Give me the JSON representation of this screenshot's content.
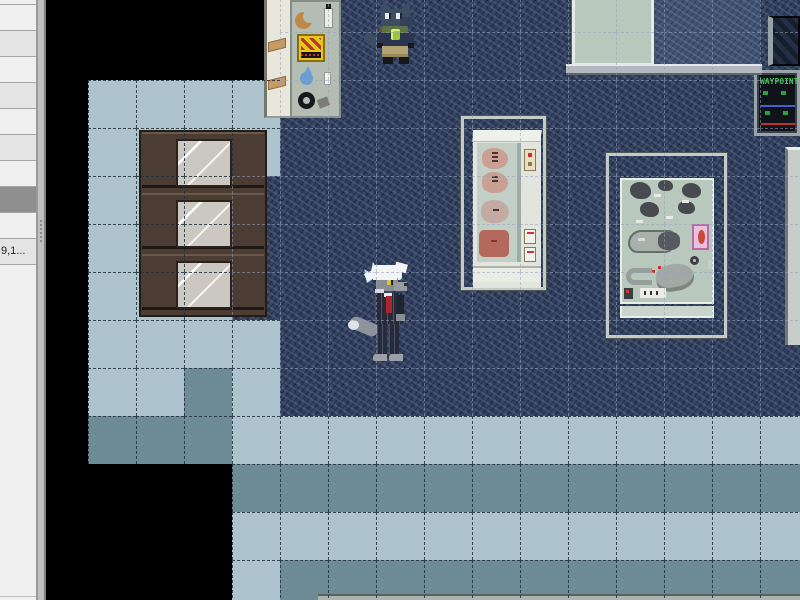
{
  "window": {
    "width": 800,
    "height": 600,
    "kind": "map-editor-viewport"
  },
  "sidebar": {
    "rows": [
      {
        "label": ""
      },
      {
        "label": ""
      },
      {
        "label": ""
      },
      {
        "label": ""
      },
      {
        "label": ""
      },
      {
        "label": ""
      },
      {
        "label": ""
      },
      {
        "label": "",
        "selected": true
      },
      {
        "label": ""
      },
      {
        "label": "9,1..."
      },
      {
        "label": ""
      }
    ],
    "colors": {
      "row_even": "#f0f0f0",
      "row_odd": "#e4e4e4",
      "selected": "#8f8f8f",
      "separator": "#a5a5a5",
      "background": "#f0f0f0",
      "splitter": "#bfbfbf"
    }
  },
  "map": {
    "tile_size": 48,
    "origin_x": -6,
    "origin_y": -16,
    "legend": {
      "K": "void-black",
      "L": "floor-light",
      "T": "floor-teal",
      "C": "carpet-dark-navy",
      "D": "carpet-light-navy"
    },
    "palette": {
      "K": "#000000",
      "L": "#adc3ce",
      "T": "#6d8c96",
      "C": "#2f3d59",
      "D": "#415372"
    },
    "grid_line_on_light": "rgba(35,48,58,0.85)",
    "grid_line_on_dark": "rgba(150,162,184,0.55)",
    "tiles": [
      "KKKKKCCCCCCCCCCC",
      "KKKKKCCCCCCCCCCC",
      "KLLLLCCCCCCCCCCC",
      "KLLLLCCCCCCCCCCC",
      "KLLLCCCCCCCCCCCC",
      "KLLLCCCCCCCCCCCC",
      "KLLLCCCCCCCCCCCC",
      "KLLLLCCCCCCCCCCC",
      "KLLTLCCCCCCCCCCC",
      "KTTTLLLLLLLLLLLL",
      "KKKKTTTTTTTTTTTT",
      "KKKKLLLLLLLLLLLL",
      "KKKKLTTTTTTTTTTT"
    ]
  },
  "entities": {
    "waypoint_sign": {
      "label": "WAYPOINT",
      "text_color": "#3ec94a",
      "accent_blue": "#4a5ad8",
      "accent_red": "#c03030"
    },
    "npc": {
      "description": "dark blue wolf with green scarf and glowing gem"
    },
    "player": {
      "description": "gray wolf with white hair in pinstripe suit and red tie"
    },
    "shelf_items": [
      "croissant",
      "bottle",
      "chips-bag",
      "water-drop",
      "pill",
      "pretzel",
      "sandwich",
      "sandwich"
    ],
    "fridge_items": [
      "meat-cut",
      "meat-cut",
      "meat-cut",
      "ham"
    ],
    "museum_items": [
      "rock",
      "rock",
      "rock",
      "rock",
      "rock",
      "rock-cluster",
      "pink-display-card",
      "ring",
      "bone-hook",
      "stone-blob",
      "label-strip"
    ]
  }
}
